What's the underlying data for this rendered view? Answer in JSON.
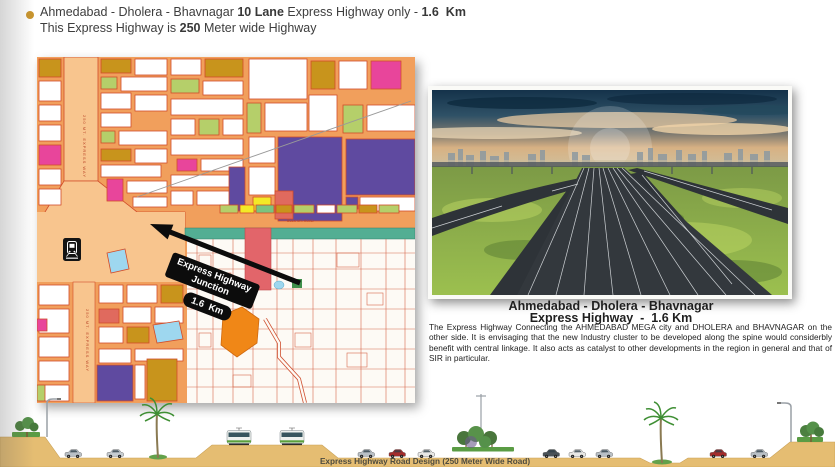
{
  "header": {
    "line1": {
      "t1": "Ahmedabad - Dholera - Bhavnagar ",
      "b1": "10 Lane",
      "t2": " Express Highway only - ",
      "b2": "1.6  Km"
    },
    "line2": {
      "t1": "This Express Highway is ",
      "b1": "250",
      "t2": " Meter wide Highway"
    }
  },
  "map": {
    "junction_label_line1": "Express Highway",
    "junction_label_line2": "Junction",
    "distance_label": "1.6  Km",
    "expressway_label": "250 MT. EXPRESS WAY",
    "road_label": "BULK MT. ROAD"
  },
  "photo": {
    "caption_title_line1": "Ahmedabad - Dholera - Bhavnagar",
    "caption_title_line2": "Express Highway  -  1.6 Km",
    "caption_body": "The Express Highway Connecting the AHMEDABAD MEGA city and DHOLERA and BHAVNAGAR on the other side. It is envisaging that the new Industry cluster to be developed along the spine would considerbly benefit with central linkage. It also acts as catalyst to other developments in the region in general and that of SIR in particular."
  },
  "cross_section": {
    "title": "Express Highway Road Design (250 Meter Wide Road)"
  },
  "icons": {
    "bullet": "bullet-dot-icon",
    "station": "metro-station-icon",
    "arrow": "direction-arrow-icon",
    "streetlight": "streetlight-icon",
    "palm": "palm-tree-icon",
    "tree": "tree-icon",
    "tram": "tram-icon",
    "car": "car-icon"
  },
  "colors": {
    "slide_bg": "#ffffff",
    "map_road_orange": "#f19f5c",
    "map_expressway_peach": "#f8c58e",
    "parcel_gold": "#c8941c",
    "parcel_green": "#b5cf6a",
    "parcel_magenta": "#e8459b",
    "parcel_purple": "#5f4aa0",
    "parcel_teal": "#53ae93",
    "parcel_yellow": "#f3e927",
    "parcel_red": "#e06a5e",
    "parcel_blue": "#9ed7ef",
    "label_bg": "#0c0c0c",
    "label_text": "#ffffff",
    "embankment_tan": "#e5bd72",
    "bullet_gold": "#c9952e"
  }
}
